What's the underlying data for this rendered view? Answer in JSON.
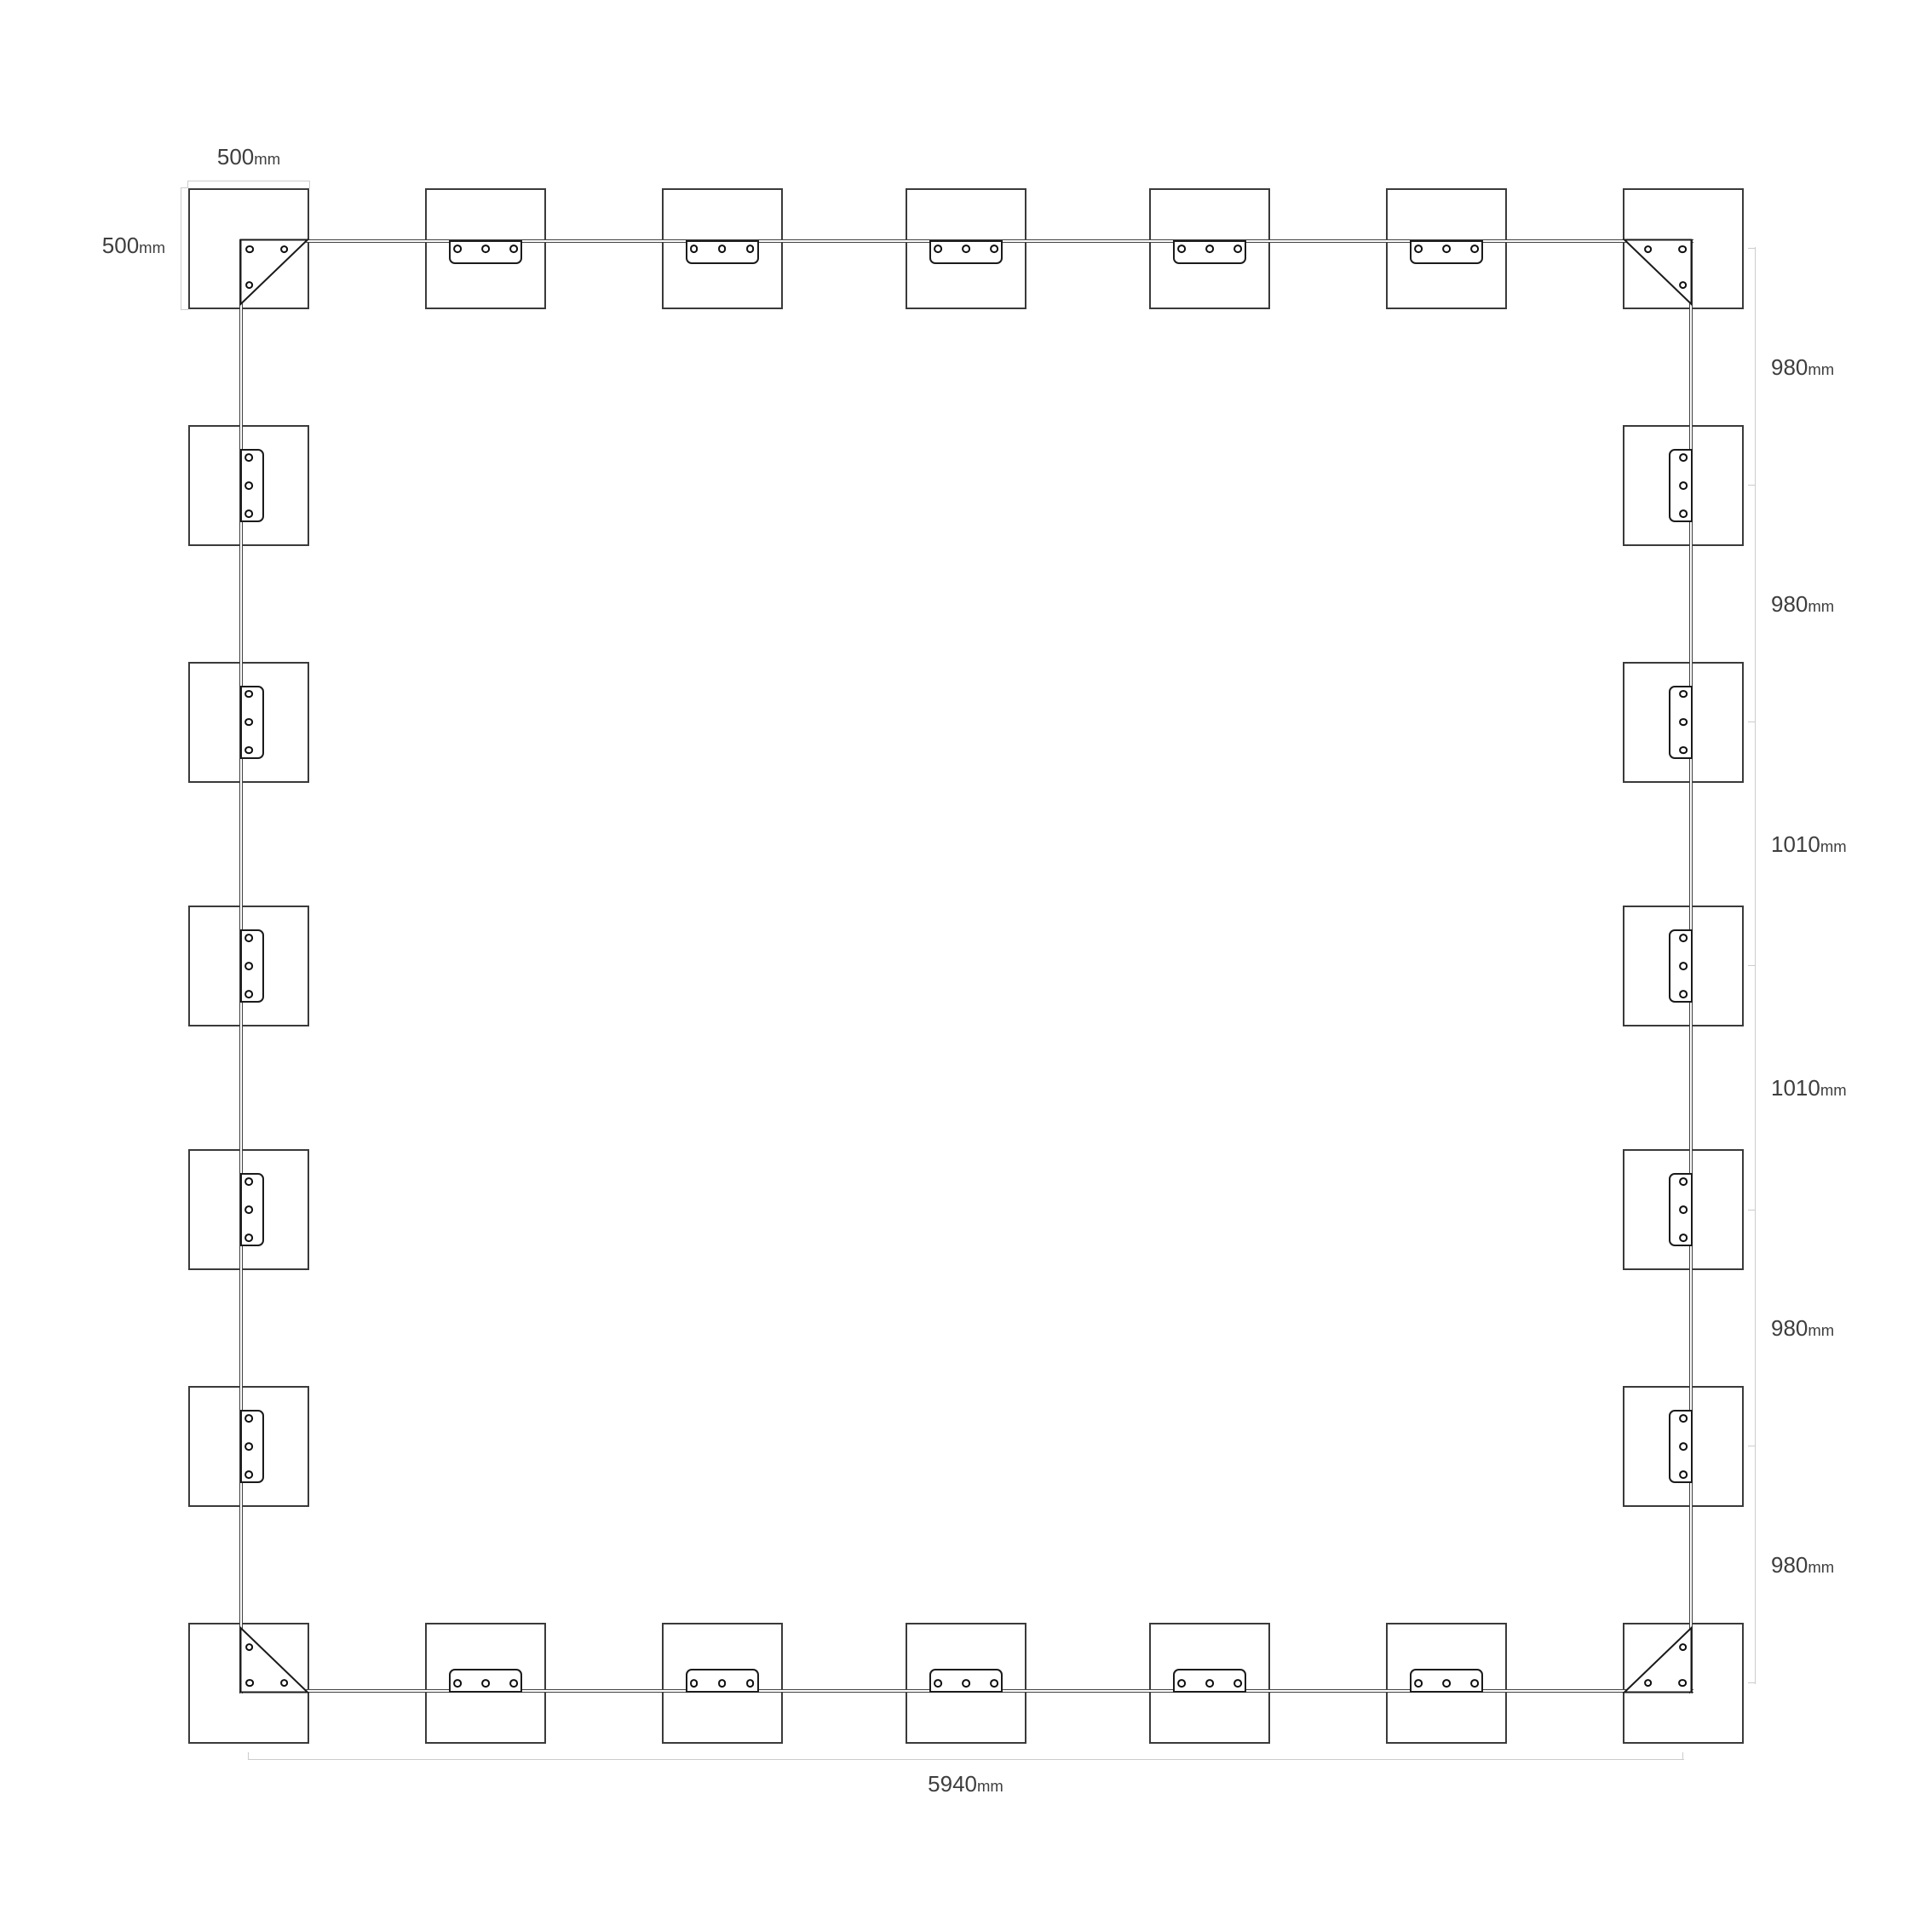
{
  "title": "Foundation pad layout plan",
  "dimensions": {
    "pad_width": {
      "value": "500",
      "unit": "mm"
    },
    "pad_height": {
      "value": "500",
      "unit": "mm"
    },
    "right_segments": [
      {
        "value": "980",
        "unit": "mm"
      },
      {
        "value": "980",
        "unit": "mm"
      },
      {
        "value": "1010",
        "unit": "mm"
      },
      {
        "value": "1010",
        "unit": "mm"
      },
      {
        "value": "980",
        "unit": "mm"
      },
      {
        "value": "980",
        "unit": "mm"
      }
    ],
    "total_span": {
      "value": "5940",
      "unit": "mm"
    }
  },
  "plan": {
    "pad_size_mm": 500,
    "post_spacing_mm": [
      980,
      980,
      1010,
      1010,
      980,
      980
    ],
    "total_span_mm": 5940,
    "posts_top_row": 7,
    "posts_bottom_row": 7,
    "posts_left_column": 5,
    "posts_right_column": 5,
    "connector_plate_holes": 3,
    "corner_plate_holes": 3
  },
  "colors": {
    "background": "#ffffff",
    "pad_stroke": "#3a3a3a",
    "plate_stroke": "#1b1b1b",
    "beam_stroke": "#404040",
    "dimension_line": "#cccccc",
    "label_text": "#3e3e3e"
  }
}
